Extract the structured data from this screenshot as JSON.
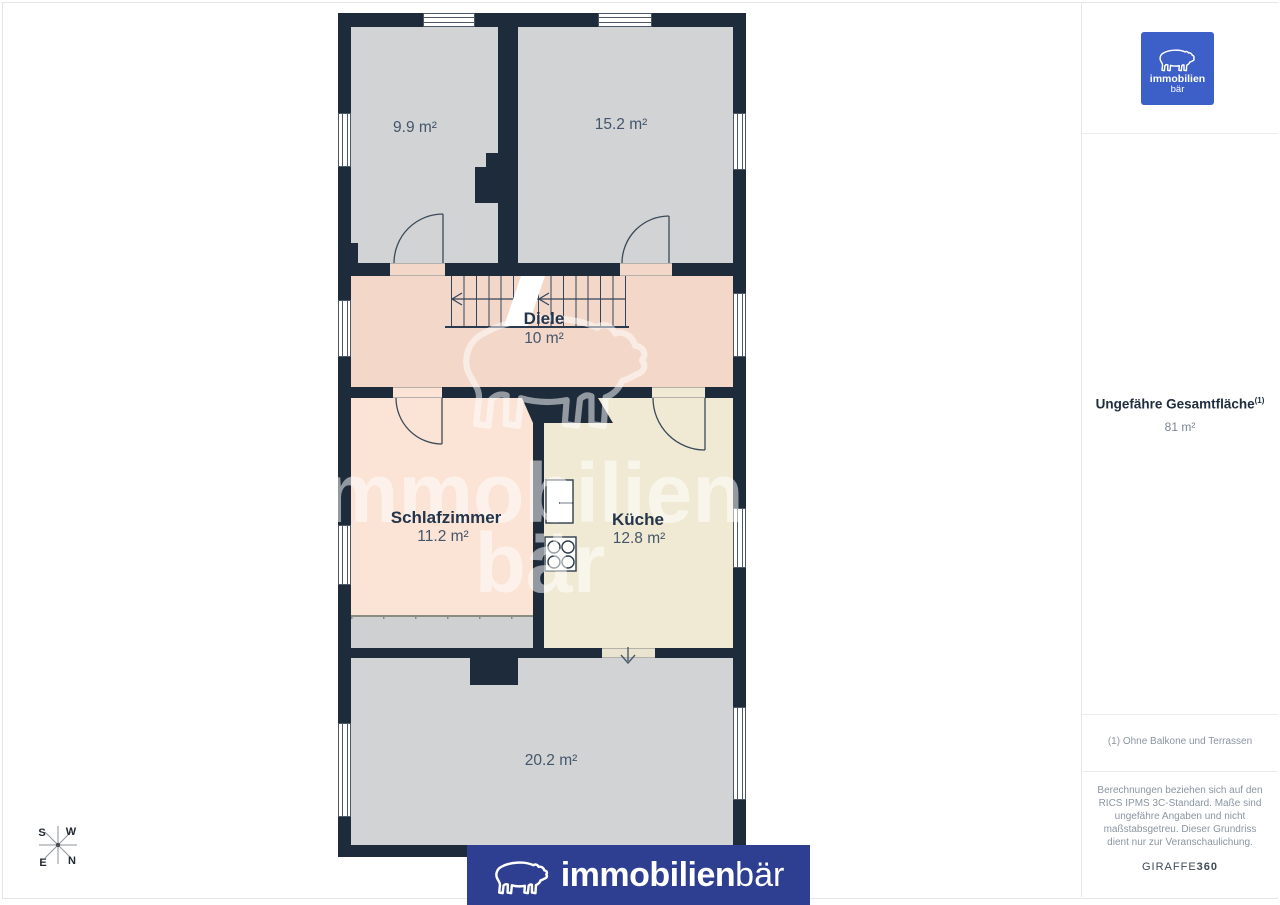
{
  "floorplan": {
    "rooms": [
      {
        "name": "",
        "area": "9.9 m²"
      },
      {
        "name": "",
        "area": "15.2 m²"
      },
      {
        "name": "Diele",
        "area": "10 m²"
      },
      {
        "name": "Schlafzimmer",
        "area": "11.2 m²"
      },
      {
        "name": "Küche",
        "area": "12.8 m²"
      },
      {
        "name": "",
        "area": "20.2 m²"
      }
    ],
    "compass": {
      "top_left": "S",
      "top_right": "W",
      "bottom_left": "E",
      "bottom_right": "N"
    }
  },
  "watermark": {
    "line1": "immobilien",
    "line2": "bär"
  },
  "sidebar": {
    "logo": {
      "line1": "immobilien",
      "line2": "bär"
    },
    "total_area_label": "Ungefähre Gesamtfläche",
    "total_area_superscript": "(1)",
    "total_area_value": "81 m²",
    "footnote": "(1) Ohne Balkone und Terrassen",
    "disclaimer": "Berechnungen beziehen sich auf den RICS IPMS 3C-Standard. Maße sind ungefähre Angaben und nicht maßstabsgetreu. Dieser Grundriss dient nur zur Veranschaulichung.",
    "provider_name": "GIRAFFE",
    "provider_number": "360"
  },
  "banner": {
    "brand_bold": "immobilien",
    "brand_light": "bär"
  },
  "colors": {
    "wall": "#1e2b3a",
    "room_gray": "#d2d3d5",
    "hallway_pink": "#f3d7c9",
    "bedroom_peach": "#fbe4d5",
    "kitchen_cream": "#f0ead4",
    "strip_gray": "#cfd0d2",
    "banner_blue": "#2e3e90",
    "logo_blue": "#3c5fc8"
  }
}
